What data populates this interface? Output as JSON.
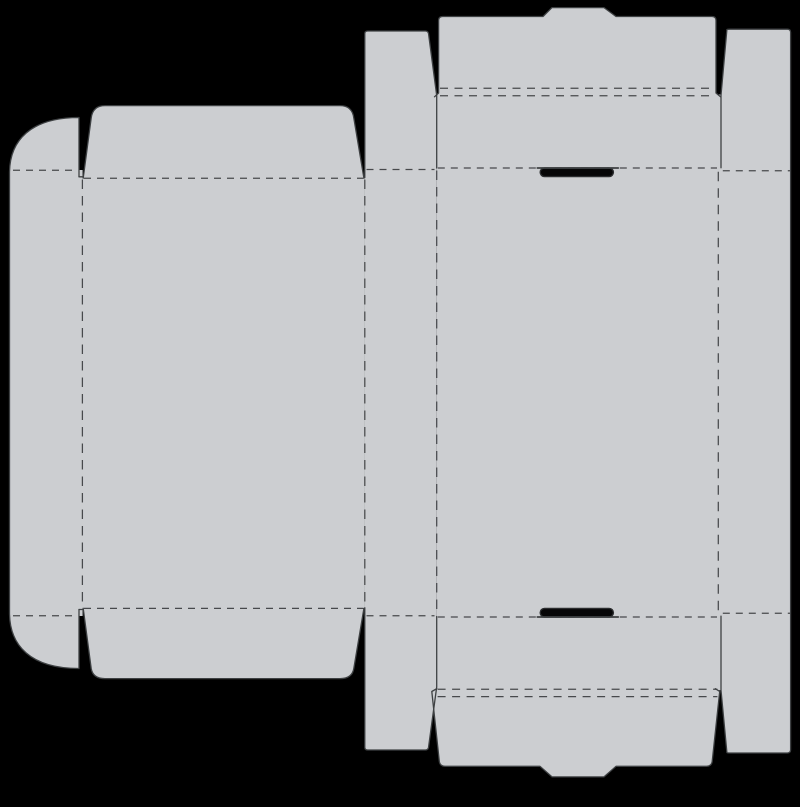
{
  "scene": {
    "title": "box-dieline-template",
    "canvas": {
      "width": 800,
      "height": 807
    },
    "colors": {
      "background": "#000000",
      "board": "#ccced1",
      "cut_line": "#3e4143",
      "fold_line": "#47494c",
      "slot_fill": "#060607",
      "slot_stroke": "#2b2d2f"
    },
    "stroke_widths": {
      "cut": 1.3,
      "fold": 1.25,
      "slot_line": 1.7,
      "slot_outline": 1.4
    }
  },
  "dieline": {
    "fills": [
      {
        "name": "left-side-wall-panel",
        "d": "M 9.5,170 H 82.6 V 616 H 9.5 Z"
      },
      {
        "name": "top-dust-flap",
        "d": "M 9.5,172 C 10,141 30,117.5 79,117.5 L 79,172 Z"
      },
      {
        "name": "bottom-dust-flap",
        "d": "M 9.5,614 C 10,645 30,668.5 79,668.5 L 79,614 Z"
      },
      {
        "name": "lid-main-panel",
        "d": "M 82.3,178 H 364.9 V 608.5 H 82.3 Z"
      },
      {
        "name": "lid-top-flap",
        "d": "M 83.2,178.5 L 91.2,118 Q 92.8,105.6 105,105.6 L 340,105.6 Q 352.2,105.6 353.8,118 L 363.9,178.5 Z"
      },
      {
        "name": "lid-bottom-flap",
        "d": "M 83.2,608 L 91.2,668.5 Q 92.8,678.6 105,678.6 L 340,678.6 Q 352.2,678.6 353.8,668.5 L 363.9,608 Z"
      },
      {
        "name": "left-wall-strip",
        "d": "M 364.8,33.5 Q 364.8,31 367.8,31 L 425.2,31 Q 428,31 428.5,33.5 L 436.7,95.5 L 436.7,687 L 428.5,747.5 Q 428,750 425.2,750 L 367.8,750 Q 364.8,750 364.8,747.5 Z"
      },
      {
        "name": "base-main-panel",
        "d": "M 436.7,94.5 H 721.2 V 690.3 H 436.7 Z"
      },
      {
        "name": "top-lock-tab",
        "d": "M 434.5,96.8 L 438.6,93 L 438.6,20.5 Q 438.6,16.5 442.6,16.5 L 543,16.5 L 552,7.6 L 604,7.6 L 616,16.5 L 712,16.5 Q 716,16.5 716,20.5 L 716,93 L 720.5,96.8 Z"
      },
      {
        "name": "bottom-lock-tab",
        "d": "M 436.7,688.7 L 431.8,691.5 L 439.3,761.3 Q 439.9,766.3 444.9,766.3 L 540,766.3 L 552,776.9 L 604,776.9 L 616,766.3 L 706.6,766.3 Q 711.6,766.3 712.2,761.3 L 719.7,691.5 L 715.3,688.7 Z"
      },
      {
        "name": "right-wall-strip",
        "d": "M 726.9,29.2 L 787.4,29.2 Q 790.6,29.2 790.6,32.4 L 790.6,749.8 Q 790.6,753 787.4,753 L 727,753 L 721,690.2 L 721,95.5 Z"
      }
    ],
    "folds": [
      {
        "name": "fold-top-dust-flap",
        "d": "M 13,170.2 H 72.5",
        "dash": "7 6"
      },
      {
        "name": "fold-bottom-dust-flap",
        "d": "M 13,615.8 H 72.5",
        "dash": "7 6"
      },
      {
        "name": "fold-lid-top-flap",
        "d": "M 84,178.3 H 363.5",
        "dash": "7 6"
      },
      {
        "name": "fold-lid-bottom-flap",
        "d": "M 84,608.4 H 363.5",
        "dash": "7 6"
      },
      {
        "name": "fold-left-strip-top",
        "d": "M 366.5,169.5 H 434.5",
        "dash": "7 6"
      },
      {
        "name": "fold-left-strip-bottom",
        "d": "M 366.5,615.7 H 434.5",
        "dash": "7 6"
      },
      {
        "name": "fold-base-top",
        "d": "M 437.8,168 H 717",
        "dash": "7 6"
      },
      {
        "name": "fold-base-bottom",
        "d": "M 437.8,617 H 717",
        "dash": "7 6"
      },
      {
        "name": "fold-top-tab-outer",
        "d": "M 440,88.3 H 715",
        "dash": "8 6.5"
      },
      {
        "name": "fold-top-tab-inner",
        "d": "M 440,95.8 H 715",
        "dash": "8 6.5"
      },
      {
        "name": "fold-bottom-tab-inner",
        "d": "M 437.6,689.2 H 717.4",
        "dash": "8 6.5"
      },
      {
        "name": "fold-bottom-tab-outer",
        "d": "M 437.6,696.6 H 717.4",
        "dash": "8 6.5"
      },
      {
        "name": "fold-right-strip-top",
        "d": "M 722.8,170.8 H 790",
        "dash": "7 6"
      },
      {
        "name": "fold-right-strip-bottom",
        "d": "M 722.8,613.3 H 790",
        "dash": "7 6"
      },
      {
        "name": "fold-left-wall-vertical",
        "d": "M 82.4,179.5 V 607.5",
        "dash": "9.5 7"
      },
      {
        "name": "fold-lid-strip-vertical",
        "d": "M 364.8,179.5 V 607",
        "dash": "9.5 7"
      },
      {
        "name": "fold-strip-base-vertical",
        "d": "M 436.7,170.5 V 614.8",
        "dash": "9.5 7"
      },
      {
        "name": "fold-base-right-vertical",
        "d": "M 718.3,171.8 V 612.5",
        "dash": "9.5 7"
      }
    ],
    "cuts": [
      {
        "name": "cut-left-wall-outline",
        "d": "M 79,176.8 L 79,117.5 C 30,117.5 10,141 9.5,172 L 9.5,614 C 10,645 30,668.5 79,668.5 L 79,609.5"
      },
      {
        "name": "cut-slit-tick-top",
        "d": "M 79,176.8 L 83.4,176.8"
      },
      {
        "name": "cut-slit-tick-bottom",
        "d": "M 79,609.5 L 83.4,609.5"
      },
      {
        "name": "cut-lid-top-flap",
        "d": "M 83.2,178.2 L 91.2,118 Q 92.8,105.6 105,105.6 L 340,105.6 Q 352.2,105.6 353.8,118 L 363.9,178"
      },
      {
        "name": "cut-lid-bottom-flap",
        "d": "M 83.2,608.3 L 91.2,668.5 Q 92.8,678.6 105,678.6 L 340,678.6 Q 352.2,678.6 353.8,668.5 L 363.9,608.5"
      },
      {
        "name": "cut-left-strip-top",
        "d": "M 364.8,177.6 L 364.8,33.5 Q 364.8,31 367.8,31 L 425.2,31 Q 428,31 428.5,33.5 L 436.7,95.5 L 436.7,168"
      },
      {
        "name": "cut-left-strip-bottom",
        "d": "M 364.8,607.8 L 364.8,747.5 Q 364.8,750 367.8,750 L 425.2,750 Q 428,750 428.5,747.5 L 436.7,687 L 436.7,616.5"
      },
      {
        "name": "cut-top-lock-tab",
        "d": "M 434.5,96.8 L 438.6,93 L 438.6,20.5 Q 438.6,16.5 442.6,16.5 L 543,16.5 L 552,7.6 L 604,7.6 L 616,16.5 L 712,16.5 Q 716,16.5 716,20.5 L 716,93 L 720.5,96.8"
      },
      {
        "name": "cut-bottom-lock-tab",
        "d": "M 436.7,688.7 L 431.8,691.5 L 439.3,761.3 Q 439.9,766.3 444.9,766.3 L 540,766.3 L 552,776.9 L 604,776.9 L 616,766.3 L 706.6,766.3 Q 711.6,766.3 712.2,761.3 L 719.7,691.5 L 715.3,688.7"
      },
      {
        "name": "cut-right-strip-outline",
        "d": "M 721,167.8 L 721,95.5 L 726.9,29.6 Q 727.3,29.2 730.2,29.2 L 787.4,29.2 Q 790.6,29.2 790.6,32.4 L 790.6,749.8 Q 790.6,753 787.4,753 L 730.2,753 Q 727.3,753 726.9,752.6 L 721,690.2 L 721,616.2"
      }
    ],
    "slot_lines": [
      {
        "name": "cut-top-slot-line",
        "d": "M 537.3,168 L 618.3,168"
      },
      {
        "name": "cut-bottom-slot-line",
        "d": "M 537.3,617 L 618.3,617"
      }
    ],
    "slots": [
      {
        "name": "top-lock-slot",
        "x": 540.2,
        "y": 168,
        "w": 73.2,
        "h": 8.6,
        "rx": 4.3
      },
      {
        "name": "bottom-lock-slot",
        "x": 540.2,
        "y": 608.4,
        "w": 73.2,
        "h": 8.6,
        "rx": 4.3
      }
    ]
  }
}
